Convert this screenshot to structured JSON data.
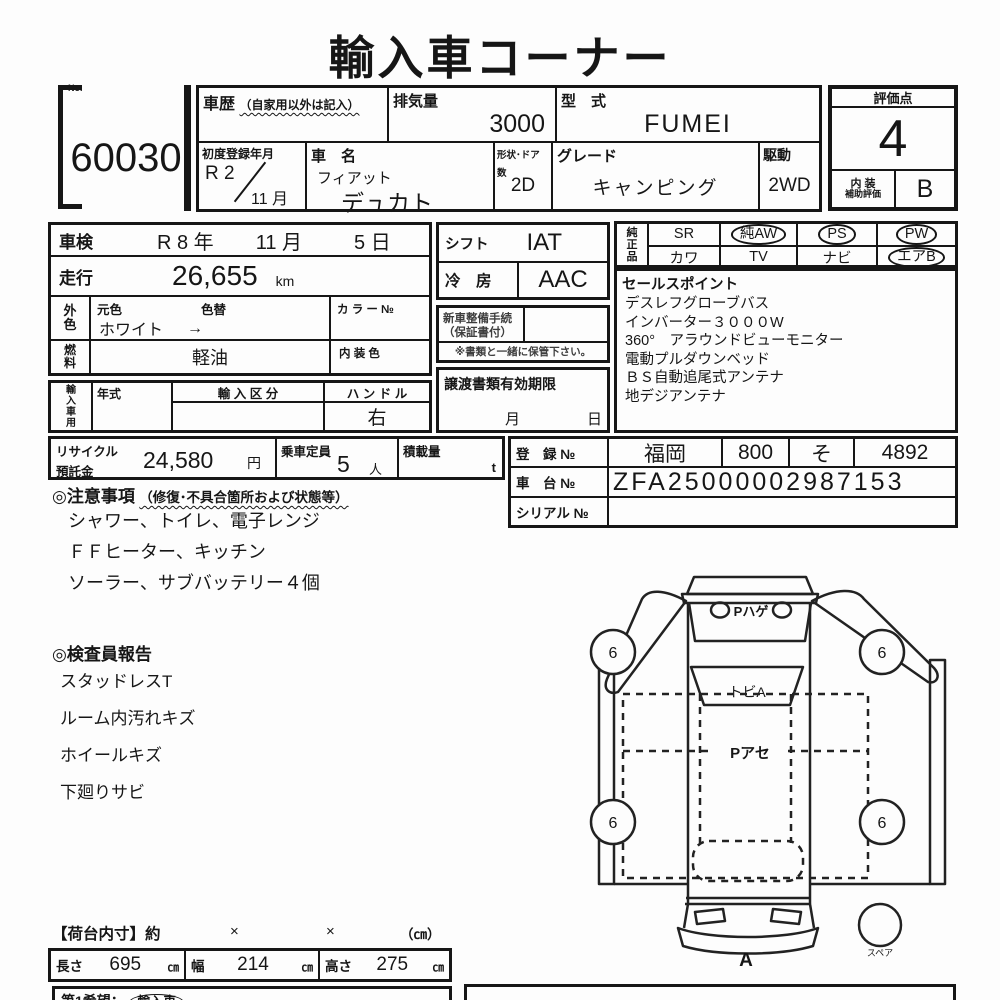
{
  "title": "輸入車コーナー",
  "lot": {
    "no_label": "No.",
    "number": "60030"
  },
  "header": {
    "history_label": "車歴",
    "history_note": "（自家用以外は記入）",
    "displacement_label": "排気量",
    "displacement_value": "3000",
    "model_code_label": "型　式",
    "model_code_value": "FUMEI",
    "first_reg_label": "初度登録年月",
    "first_reg_year": "R 2",
    "first_reg_month": "11 月",
    "car_name_label": "車　名",
    "car_maker": "フィアット",
    "car_model": "デュカト",
    "body_doors_label": "形状･ドア数",
    "body_doors_value": "2D",
    "grade_label": "グレード",
    "grade_value": "キャンピング",
    "drive_label": "駆動",
    "drive_value": "2WD"
  },
  "score": {
    "label": "評価点",
    "value": "4",
    "interior_label_1": "内 装",
    "interior_label_2": "補助評価",
    "interior_value": "B"
  },
  "left_panel": {
    "shaken_label": "車検",
    "shaken_year": "R 8 年",
    "shaken_month": "11 月",
    "shaken_day": "5 日",
    "mileage_label": "走行",
    "mileage_value": "26,655",
    "mileage_unit": "km",
    "color_label_1": "外",
    "color_label_2": "色",
    "base_color_label": "元色",
    "color_change_label": "色替",
    "color_no_label": "カ ラ ー №",
    "base_color_value": "ホワイト",
    "color_arrow": "→",
    "fuel_label_1": "燃",
    "fuel_label_2": "料",
    "fuel_value": "軽油",
    "interior_color_label": "内 装 色",
    "import_label": "輸入車用",
    "year_label": "年式",
    "import_class_label": "輸 入 区 分",
    "handle_label": "ハ ン ド ル",
    "handle_value": "右"
  },
  "middle_panel": {
    "shift_label": "シフト",
    "shift_value": "IAT",
    "ac_label": "冷　房",
    "ac_value": "AAC",
    "maintenance_label_1": "新車整備手続",
    "maintenance_label_2": "（保証書付）",
    "keep_note": "※書類と一緒に保管下さい。",
    "transfer_label": "譲渡書類有効期限",
    "transfer_month_label": "月",
    "transfer_day_label": "日"
  },
  "equipment": {
    "label": "純正品",
    "items": [
      {
        "label": "SR",
        "circled": false
      },
      {
        "label": "純AW",
        "circled": true
      },
      {
        "label": "PS",
        "circled": true
      },
      {
        "label": "PW",
        "circled": true
      },
      {
        "label": "カワ",
        "circled": false
      },
      {
        "label": "TV",
        "circled": false
      },
      {
        "label": "ナビ",
        "circled": false
      },
      {
        "label": "エアB",
        "circled": true
      }
    ]
  },
  "sales_points": {
    "label": "セールスポイント",
    "lines": [
      "デスレフグローブバス",
      "インバーター３０００W",
      "360°　アラウンドビューモニター",
      "電動プルダウンベッド",
      "ＢＳ自動追尾式アンテナ",
      "地デジアンテナ"
    ]
  },
  "recycle": {
    "label_1": "リサイクル",
    "label_2": "預託金",
    "value": "24,580",
    "unit": "円",
    "capacity_label": "乗車定員",
    "capacity_value": "5",
    "capacity_unit": "人",
    "load_label": "積載量",
    "load_unit": "t"
  },
  "registration": {
    "reg_label": "登　録 №",
    "reg_region": "福岡",
    "reg_class": "800",
    "reg_kana": "そ",
    "reg_number": "4892",
    "chassis_label": "車　台 №",
    "chassis_value": "ZFA25000002987153",
    "serial_label": "シリアル №"
  },
  "notes": {
    "heading": "◎注意事項",
    "heading_note": "（修復･不具合箇所および状態等）",
    "lines": [
      "シャワー、トイレ、電子レンジ",
      "ＦＦヒーター、キッチン",
      "ソーラー、サブバッテリー４個"
    ]
  },
  "inspector_report": {
    "heading": "◎検査員報告",
    "lines": [
      "スタッドレスT",
      "ルーム内汚れキズ",
      "ホイールキズ",
      "下廻りサビ"
    ]
  },
  "diagram": {
    "rear_label": "Pハゲ",
    "rear_window_label": "トビA",
    "roof_label": "Pアセ",
    "wheel_marks": [
      "6",
      "6",
      "6",
      "6"
    ],
    "front_label": "A",
    "spare_label": "スペア"
  },
  "cargo": {
    "heading": "【荷台内寸】約",
    "times_1": "×",
    "times_2": "×",
    "unit_note": "（㎝）",
    "length_label": "長さ",
    "length_value": "695",
    "length_unit": "㎝",
    "width_label": "幅",
    "width_value": "214",
    "width_unit": "㎝",
    "height_label": "高さ",
    "height_value": "275",
    "height_unit": "㎝"
  },
  "footer": {
    "wish_label": "第1希望：",
    "wish_value": "輸入車"
  }
}
